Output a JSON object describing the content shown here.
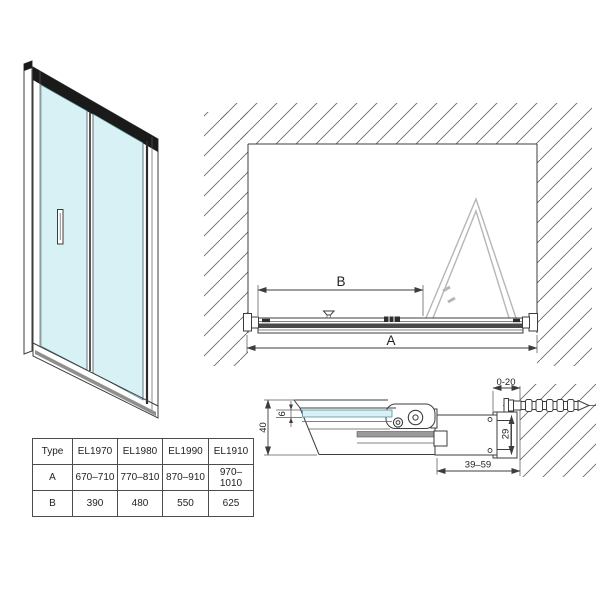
{
  "colors": {
    "glass": "#d7f1f4",
    "glass_edge": "#58929b",
    "line": "#3d3d3d",
    "folded_door": "#b6b6b6",
    "dark_rail": "#1a1a1a",
    "track_strip": "#4a4a4a",
    "gray_strip": "#8f8f8f",
    "hatch": "#6b6b6b"
  },
  "plan_view": {
    "dim_a": "A",
    "dim_b": "B"
  },
  "section_view": {
    "dim_height": "40",
    "dim_glass": "6",
    "dim_adjust": "0-20",
    "dim_profile": "29",
    "dim_depth": "39–59"
  },
  "table": {
    "headers": [
      "Type",
      "EL1970",
      "EL1980",
      "EL1990",
      "EL1910"
    ],
    "rows": [
      {
        "label": "A",
        "values": [
          "670–710",
          "770–810",
          "870–910",
          "970–1010"
        ]
      },
      {
        "label": "B",
        "values": [
          "390",
          "480",
          "550",
          "625"
        ]
      }
    ]
  }
}
